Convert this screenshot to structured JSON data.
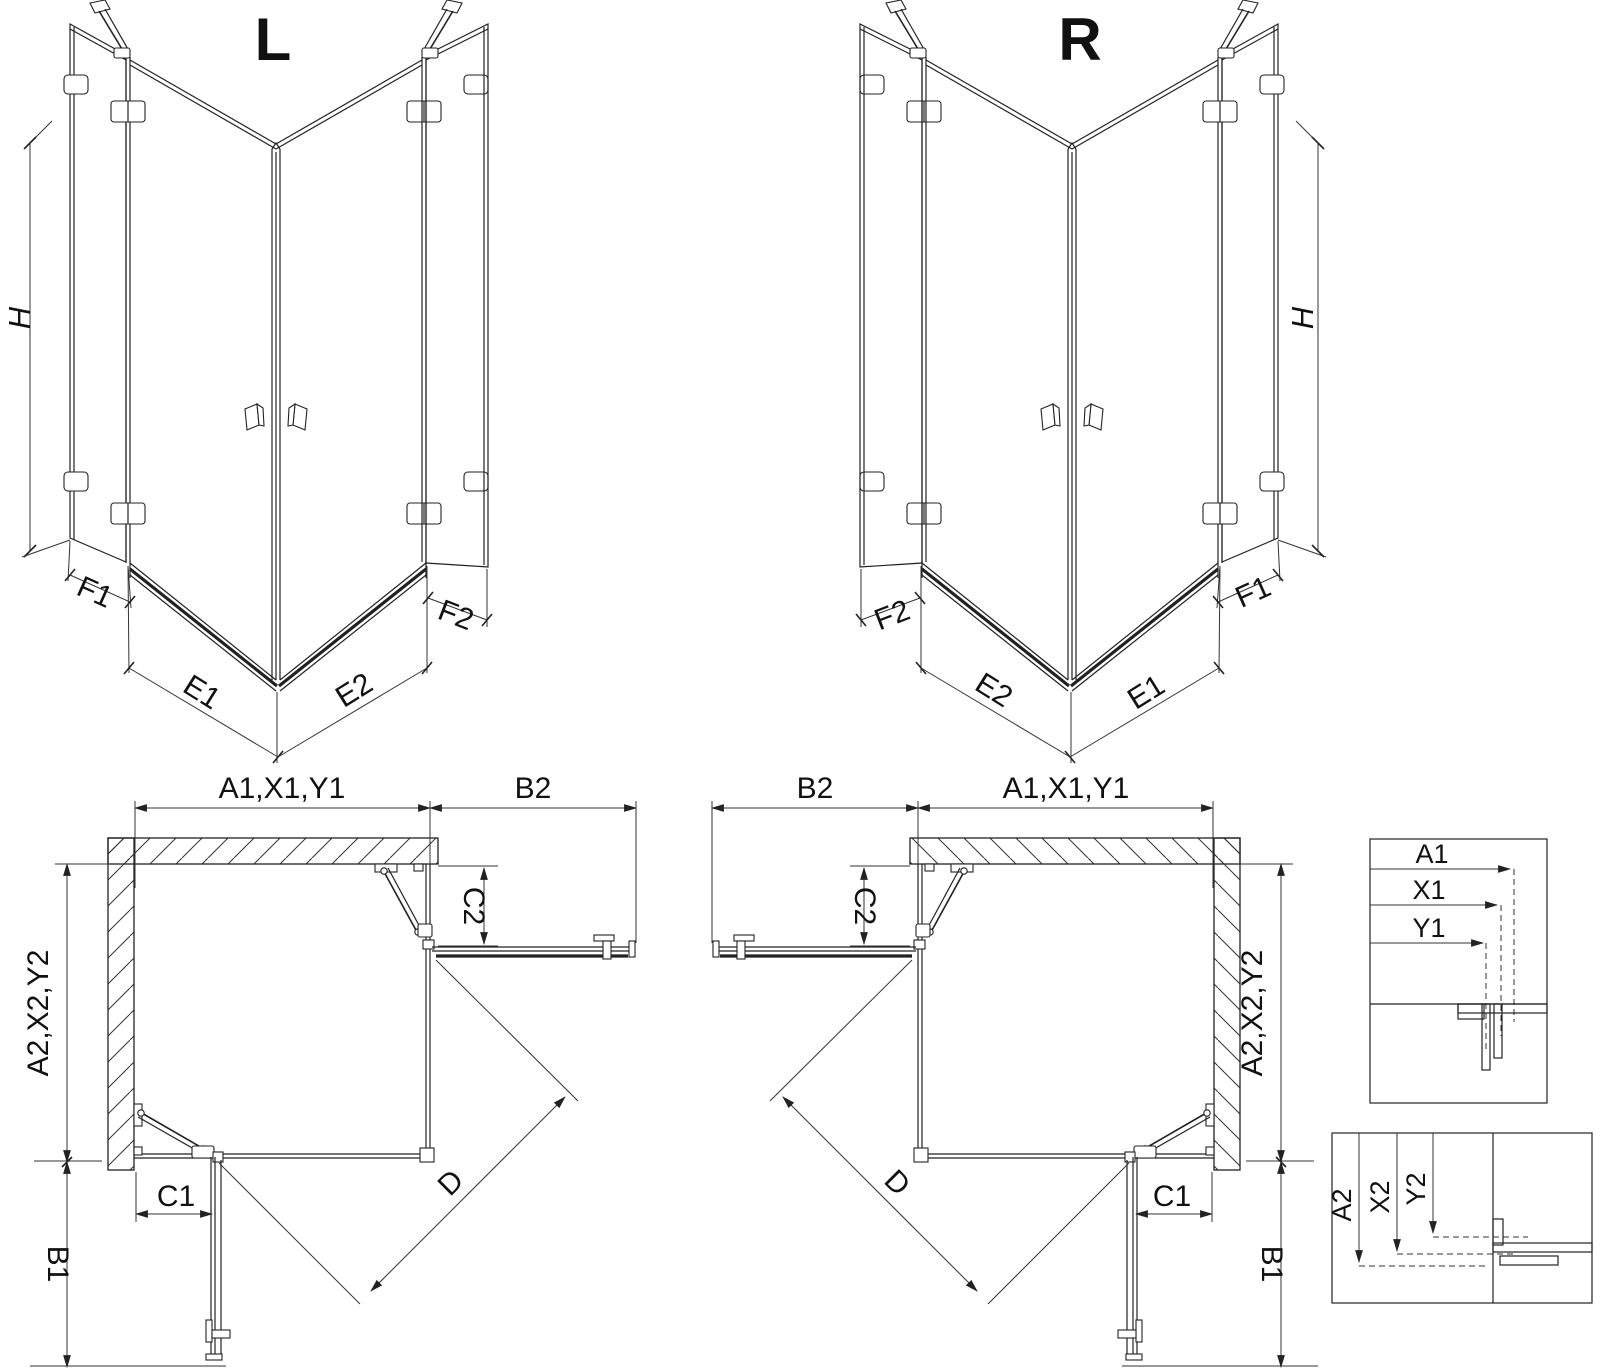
{
  "drawing": {
    "type": "corner shower enclosure technical drawing",
    "variant_labels": {
      "left": "L",
      "right": "R"
    },
    "dimensions": {
      "height": "H",
      "front_widths": {
        "f1": "F1",
        "e1": "E1",
        "e2": "E2",
        "f2": "F2"
      },
      "plan": {
        "top_width": "A1,X1,Y1",
        "side_depth": "A2,X2,Y2",
        "b1": "B1",
        "b2": "B2",
        "c1": "C1",
        "c2": "C2",
        "diagonal": "D"
      },
      "detail_width": {
        "a1": "A1",
        "x1": "X1",
        "y1": "Y1"
      },
      "detail_depth": {
        "a2": "A2",
        "x2": "X2",
        "y2": "Y2"
      }
    },
    "colors": {
      "line": "#222222",
      "background": "#ffffff"
    }
  }
}
